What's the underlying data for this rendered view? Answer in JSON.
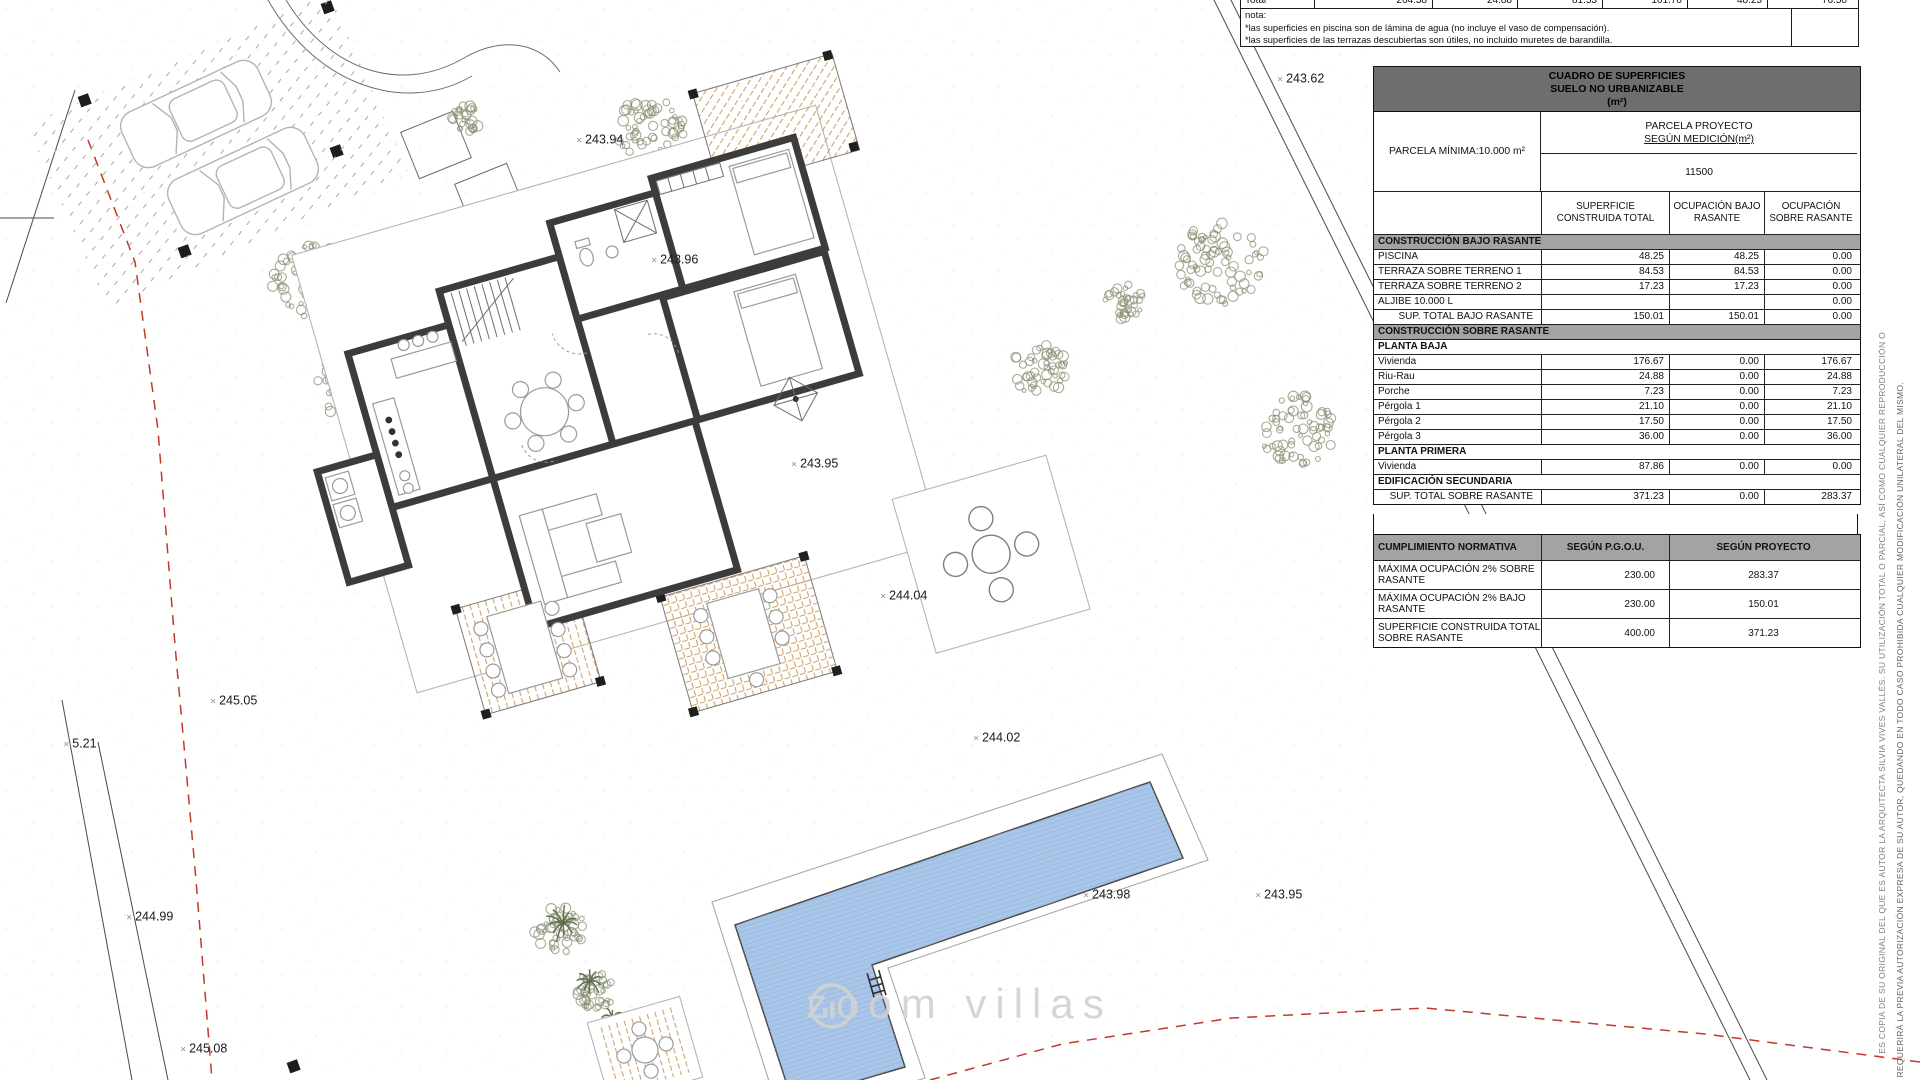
{
  "watermark": {
    "text": "zoom villas"
  },
  "top_notes": {
    "total_row": {
      "label": "Total",
      "values": [
        "264.38",
        "24.88",
        "81.53",
        "101.70",
        "48.25",
        "76.50"
      ]
    },
    "nota_label": "nota:",
    "footnotes": [
      "*las superficies en piscina son de lámina de agua (no incluye el vaso de compensación).",
      "*las superficies de las terrazas descubiertas son útiles, no incluido muretes de barandilla."
    ]
  },
  "surfaces_table": {
    "title_lines": [
      "CUADRO DE SUPERFICIES",
      "SUELO NO URBANIZABLE",
      "(m²)"
    ],
    "parcela_minima": "PARCELA MÍNIMA:10.000 m²",
    "parcela_proyecto": [
      "PARCELA PROYECTO",
      "SEGÚN MEDICIÓN(m²)"
    ],
    "parcela_value": "11500",
    "columns": [
      "SUPERFICIE CONSTRUIDA TOTAL",
      "OCUPACIÓN BAJO RASANTE",
      "OCUPACIÓN SOBRE RASANTE"
    ],
    "rows": [
      {
        "type": "section",
        "label": "CONSTRUCCIÓN BAJO RASANTE",
        "values": []
      },
      {
        "type": "data",
        "label": "PISCINA",
        "values": [
          "48.25",
          "48.25",
          "0.00"
        ]
      },
      {
        "type": "data",
        "label": "TERRAZA SOBRE TERRENO 1",
        "values": [
          "84.53",
          "84.53",
          "0.00"
        ]
      },
      {
        "type": "data",
        "label": "TERRAZA SOBRE TERRENO 2",
        "values": [
          "17.23",
          "17.23",
          "0.00"
        ]
      },
      {
        "type": "data",
        "label": "ALJIBE 10.000 L",
        "values": [
          "",
          "",
          "0.00"
        ]
      },
      {
        "type": "total",
        "label": "SUP. TOTAL BAJO RASANTE",
        "values": [
          "150.01",
          "150.01",
          "0.00"
        ]
      },
      {
        "type": "section",
        "label": "CONSTRUCCIÓN SOBRE RASANTE",
        "values": []
      },
      {
        "type": "subheader",
        "label": "PLANTA BAJA",
        "values": []
      },
      {
        "type": "data",
        "label": "Vivienda",
        "values": [
          "176.67",
          "0.00",
          "176.67"
        ]
      },
      {
        "type": "data",
        "label": "Riu-Rau",
        "values": [
          "24.88",
          "0.00",
          "24.88"
        ]
      },
      {
        "type": "data",
        "label": "Porche",
        "values": [
          "7.23",
          "0.00",
          "7.23"
        ]
      },
      {
        "type": "data",
        "label": "Pérgola 1",
        "values": [
          "21.10",
          "0.00",
          "21.10"
        ]
      },
      {
        "type": "data",
        "label": "Pérgola 2",
        "values": [
          "17.50",
          "0.00",
          "17.50"
        ]
      },
      {
        "type": "data",
        "label": "Pérgola 3",
        "values": [
          "36.00",
          "0.00",
          "36.00"
        ]
      },
      {
        "type": "subheader",
        "label": "PLANTA PRIMERA",
        "values": []
      },
      {
        "type": "data",
        "label": "Vivienda",
        "values": [
          "87.86",
          "0.00",
          "0.00"
        ]
      },
      {
        "type": "subheader",
        "label": "EDIFICACIÓN SECUNDARIA",
        "values": []
      },
      {
        "type": "total",
        "label": "SUP. TOTAL SOBRE RASANTE",
        "values": [
          "371.23",
          "0.00",
          "283.37"
        ]
      }
    ]
  },
  "compliance_table": {
    "headers": [
      "CUMPLIMIENTO NORMATIVA",
      "SEGÚN P.G.O.U.",
      "SEGÚN PROYECTO"
    ],
    "rows": [
      {
        "label": "MÁXIMA OCUPACIÓN 2% SOBRE RASANTE",
        "pgou": "230.00",
        "proyecto": "283.37"
      },
      {
        "label": "MÁXIMA OCUPACIÓN 2% BAJO RASANTE",
        "pgou": "230.00",
        "proyecto": "150.01"
      },
      {
        "label": "SUPERFICIE CONSTRUIDA TOTAL SOBRE RASANTE",
        "pgou": "400.00",
        "proyecto": "371.23"
      }
    ]
  },
  "elevation_labels": [
    {
      "text": "243.94",
      "x": 580,
      "y": 140
    },
    {
      "text": "243.96",
      "x": 655,
      "y": 260
    },
    {
      "text": "243.62",
      "x": 1281,
      "y": 79
    },
    {
      "text": "243.95",
      "x": 795,
      "y": 464
    },
    {
      "text": "244.04",
      "x": 884,
      "y": 596
    },
    {
      "text": "245.05",
      "x": 214,
      "y": 701
    },
    {
      "text": "5.21",
      "x": 66,
      "y": 744
    },
    {
      "text": "244.02",
      "x": 977,
      "y": 738
    },
    {
      "text": "243.98",
      "x": 1087,
      "y": 895
    },
    {
      "text": "243.95",
      "x": 1259,
      "y": 895
    },
    {
      "text": "244.99",
      "x": 130,
      "y": 917
    },
    {
      "text": "245.08",
      "x": 184,
      "y": 1049
    }
  ],
  "legal_vertical_text": [
    "ES COPIA DE SU ORIGINAL DEL QUE ES AUTOR LA ARQUITECTA SILVIA VIVES VALLÉS. SU UTILIZACIÓN TOTAL O PARCIAL, ASÍ COMO CUALQUIER REPRODUCCIÓN O",
    "REQUERIRÁ LA PREVIA AUTORIZACIÓN EXPRESA DE SU AUTOR, QUEDANDO EN TODO CASO PROHIBIDA CUALQUIER MODIFICACIÓN UNILATERAL DEL MISMO."
  ],
  "colors": {
    "pool_fill": "#a9c6e8",
    "pool_hatch": "#8fb2dc",
    "wall": "#3c3c3c",
    "terrace_hatch": "#cfa36a",
    "tree": "#8b9276",
    "red_dash": "#c0392b",
    "table_title_bg": "#6e6e6e",
    "section_bg": "#a3a3a3",
    "watermark": "#d2d2d2"
  }
}
